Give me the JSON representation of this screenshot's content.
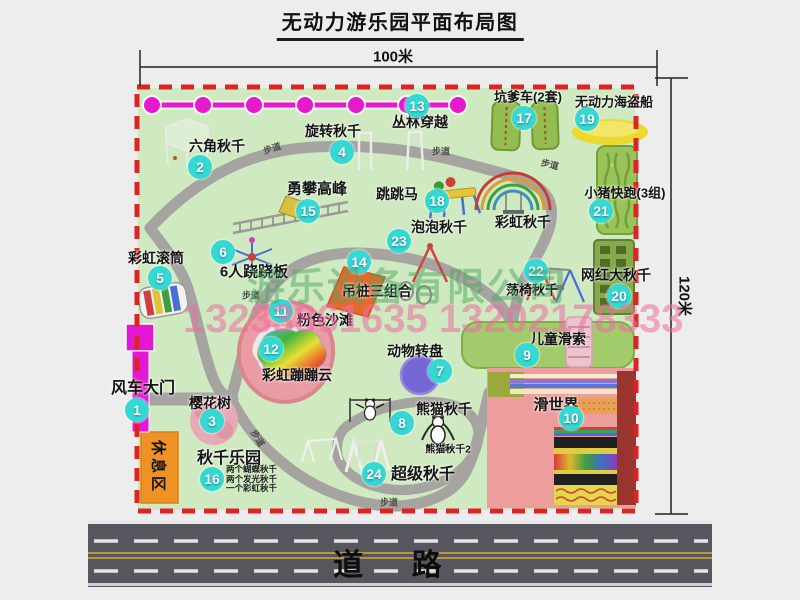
{
  "title": "无动力游乐园平面布局图",
  "dimensions": {
    "width": "100米",
    "height": "120米"
  },
  "road": {
    "label": "道 路"
  },
  "rest_area_label": "休息区",
  "walkway_label": "步道",
  "rainbow_swing_label": "彩虹秋千",
  "panda_swing2_label": "熊猫秋千2",
  "watermark": {
    "company": "游乐设备有限公司",
    "phone": "13233861635 13202178333"
  },
  "attractions": [
    {
      "num": "1",
      "name": "风车大门"
    },
    {
      "num": "2",
      "name": "六角秋千"
    },
    {
      "num": "3",
      "name": "樱花树"
    },
    {
      "num": "4",
      "name": "旋转秋千"
    },
    {
      "num": "5",
      "name": "彩虹滚筒"
    },
    {
      "num": "6",
      "name": "6人跷跷板"
    },
    {
      "num": "7",
      "name": "动物转盘"
    },
    {
      "num": "8",
      "name": "熊猫秋千"
    },
    {
      "num": "9",
      "name": "儿童滑索"
    },
    {
      "num": "10",
      "name": "滑世界"
    },
    {
      "num": "11",
      "name": "粉色沙滩"
    },
    {
      "num": "12",
      "name": "彩虹蹦蹦云"
    },
    {
      "num": "13",
      "name": "丛林穿越"
    },
    {
      "num": "14",
      "name": "吊桩三组合"
    },
    {
      "num": "15",
      "name": "勇攀高峰"
    },
    {
      "num": "16",
      "name": "秋千乐园",
      "details": [
        "两个蝴蝶秋千",
        "两个发光秋千",
        "一个彩虹秋千"
      ]
    },
    {
      "num": "17",
      "name": "坑爹车(2套)"
    },
    {
      "num": "18",
      "name": "跳跳马"
    },
    {
      "num": "19",
      "name": "无动力海盗船"
    },
    {
      "num": "20",
      "name": "网红大秋千"
    },
    {
      "num": "21",
      "name": "小猪快跑(3组)"
    },
    {
      "num": "22",
      "name": "荡椅秋千"
    },
    {
      "num": "23",
      "name": "泡泡秋千"
    },
    {
      "num": "24",
      "name": "超级秋千"
    }
  ],
  "colors": {
    "badge": "#35d9d3",
    "border_dashed": "#dd2323",
    "map_fill": "#cfe9c0",
    "chain": "#e619cf",
    "road": "#56565e",
    "rest_area": "#ef9226"
  }
}
